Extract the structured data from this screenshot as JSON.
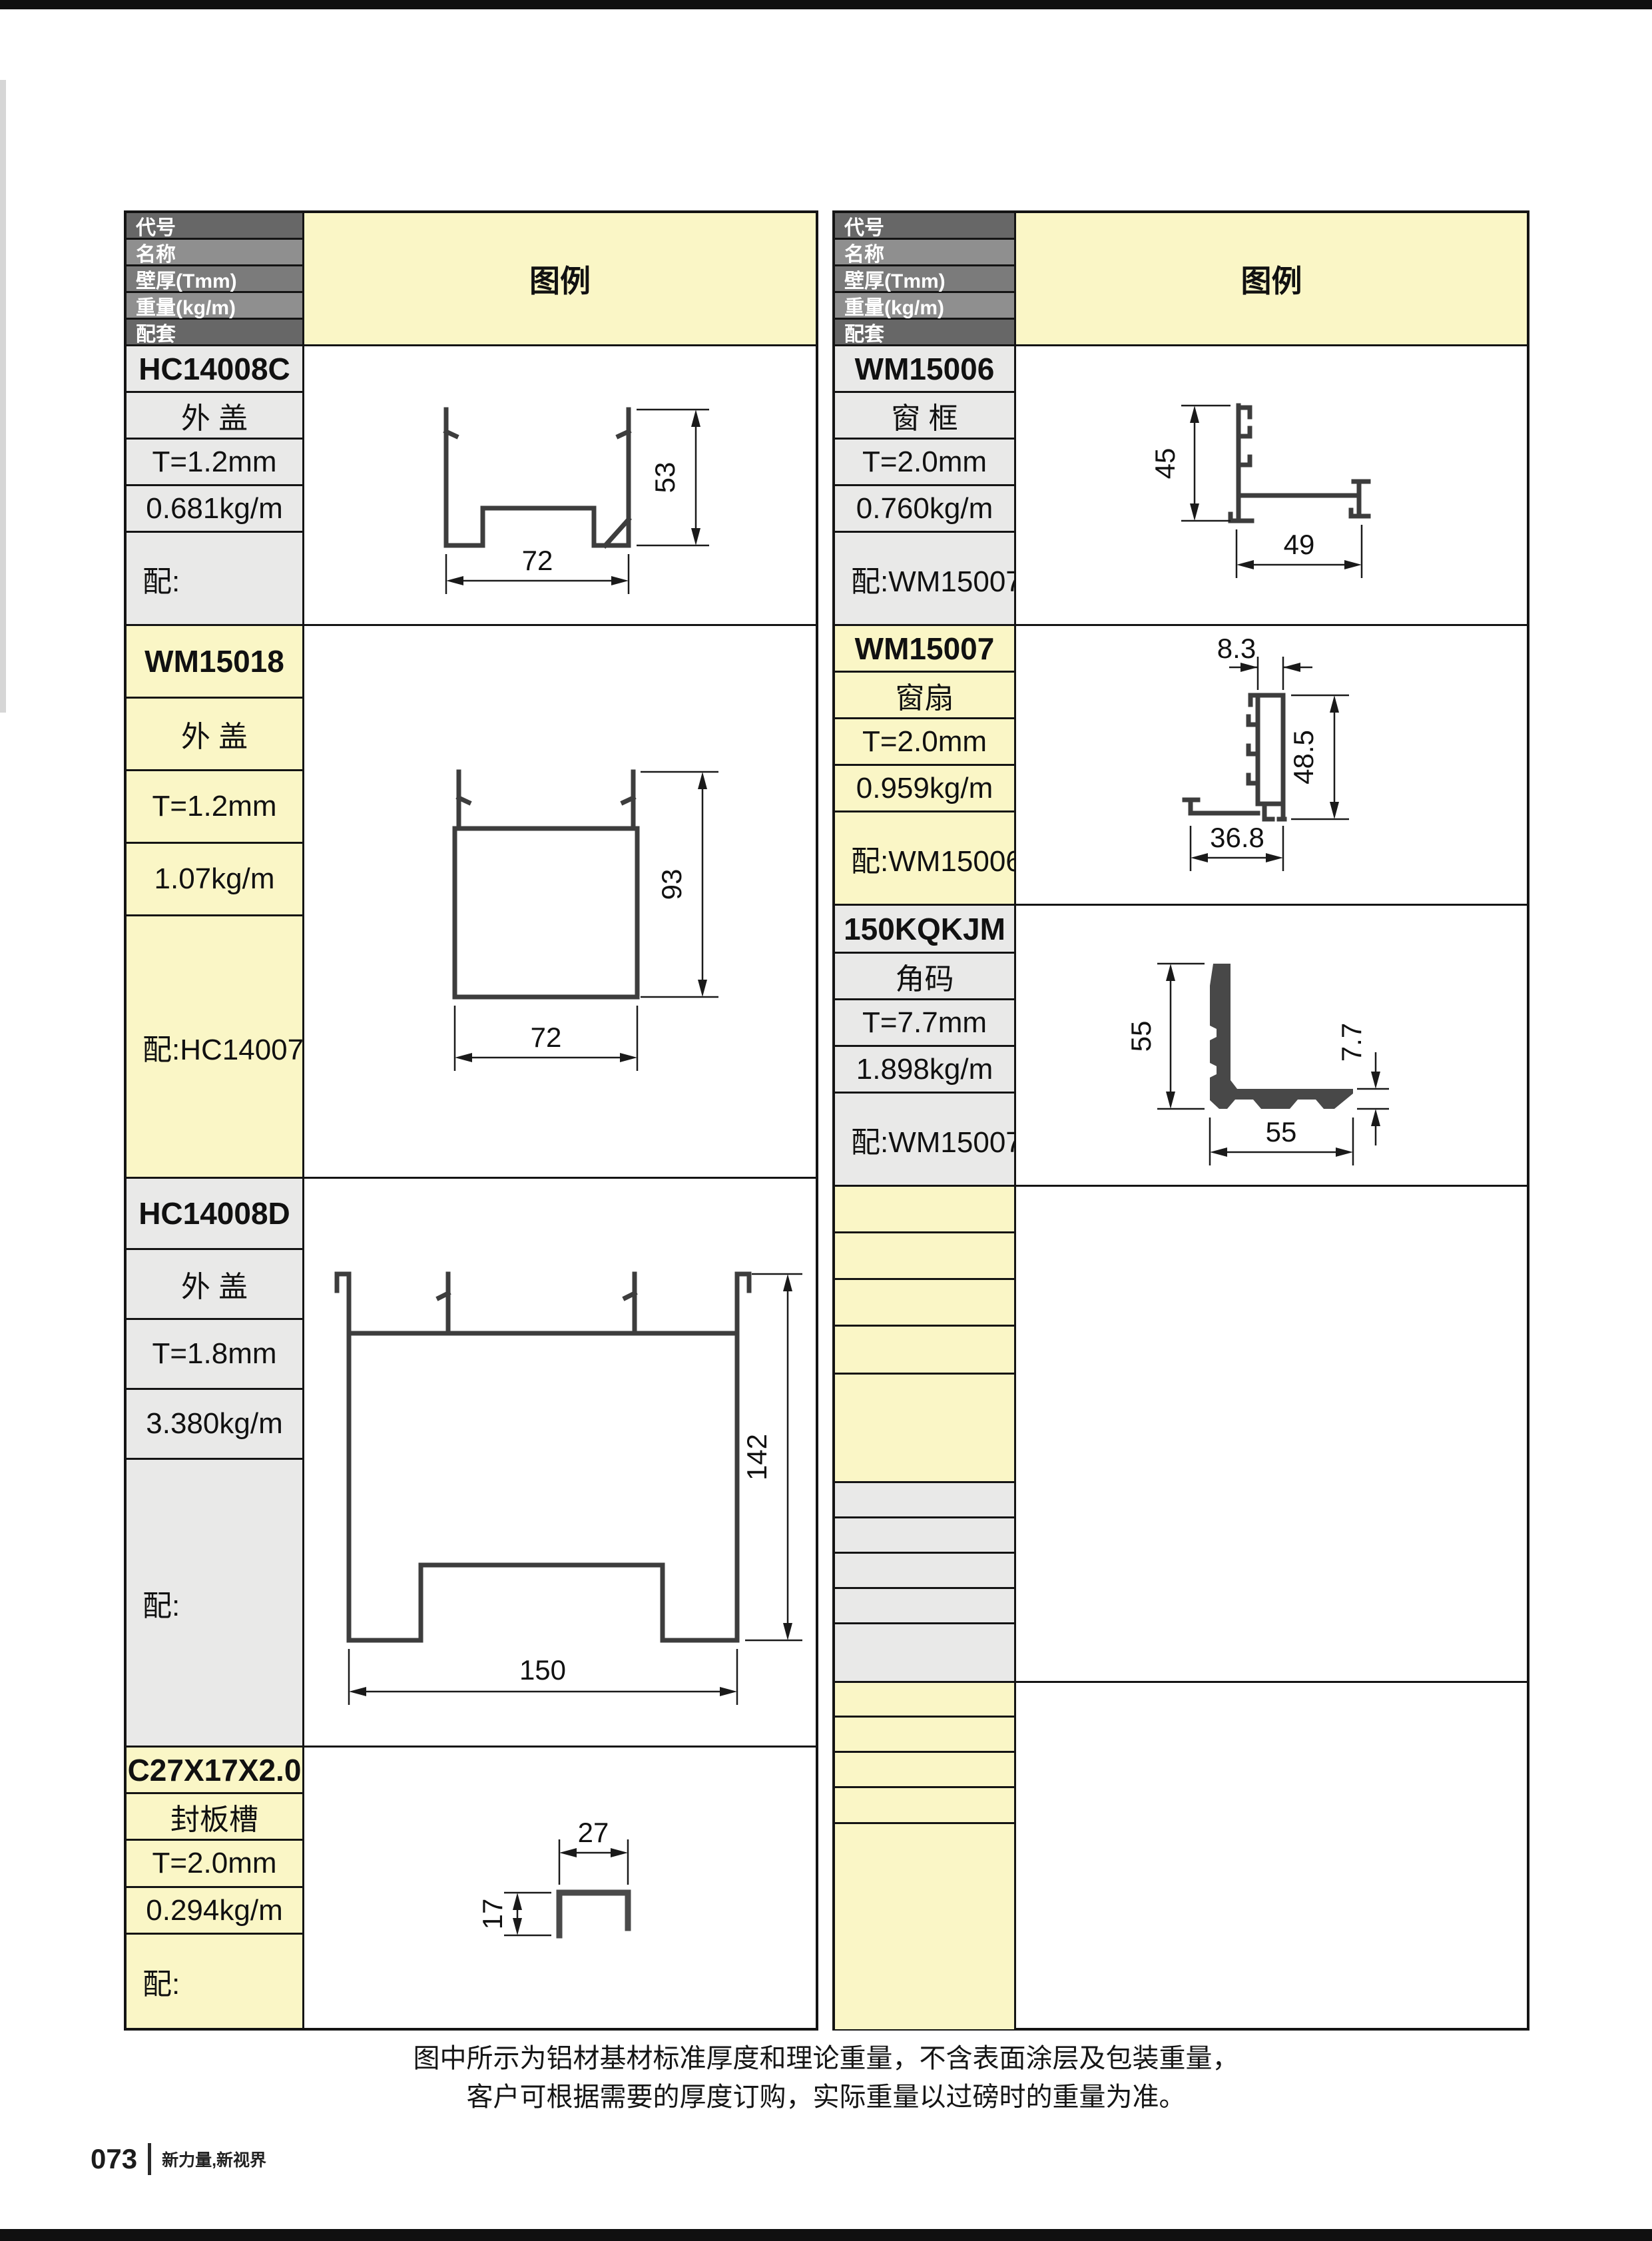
{
  "header": {
    "rows": [
      "代号",
      "名称",
      "壁厚(Tmm)",
      "重量(kg/m)",
      "配套"
    ],
    "legend": "图例"
  },
  "left_table": {
    "sections": [
      {
        "code": "HC14008C",
        "name": "外 盖",
        "thickness": "T=1.2mm",
        "weight": "0.681kg/m",
        "match": "配:"
      },
      {
        "code": "WM15018",
        "name": "外 盖",
        "thickness": "T=1.2mm",
        "weight": "1.07kg/m",
        "match": "配:HC14007"
      },
      {
        "code": "HC14008D",
        "name": "外 盖",
        "thickness": "T=1.8mm",
        "weight": "3.380kg/m",
        "match": "配:"
      },
      {
        "code": "C27X17X2.0",
        "name": "封板槽",
        "thickness": "T=2.0mm",
        "weight": "0.294kg/m",
        "match": "配:"
      }
    ]
  },
  "right_table": {
    "sections": [
      {
        "code": "WM15006",
        "name": "窗 框",
        "thickness": "T=2.0mm",
        "weight": "0.760kg/m",
        "match": "配:WM15007"
      },
      {
        "code": "WM15007",
        "name": "窗扇",
        "thickness": "T=2.0mm",
        "weight": "0.959kg/m",
        "match": "配:WM15006"
      },
      {
        "code": "150KQKJM",
        "name": "角码",
        "thickness": "T=7.7mm",
        "weight": "1.898kg/m",
        "match": "配:WM15007"
      }
    ]
  },
  "drawings": {
    "hc14008c": {
      "width": "72",
      "height": "53"
    },
    "wm15018": {
      "width": "72",
      "height": "93"
    },
    "hc14008d": {
      "width": "150",
      "height": "142"
    },
    "c27x17": {
      "width": "27",
      "height": "17"
    },
    "wm15006": {
      "height": "45",
      "width": "49"
    },
    "wm15007": {
      "top_width": "8.3",
      "height": "48.5",
      "bottom_width": "36.8"
    },
    "kqkjm_150": {
      "height": "55",
      "width": "55",
      "thickness": "7.7"
    }
  },
  "notes": {
    "line1": "图中所示为铝材基材标准厚度和理论重量，不含表面涂层及包装重量，",
    "line2": "客户可根据需要的厚度订购，实际重量以过磅时的重量为准。"
  },
  "footer": {
    "page_number": "073",
    "slogan": "新力量,新视界"
  },
  "colors": {
    "highlight_yellow": "#FAF6C6",
    "cell_gray": "#E9E9E8",
    "header_dark": "#676767",
    "header_mid": "#8F8F8F",
    "border": "#141414",
    "profile_stroke": "#3D3D3D"
  }
}
